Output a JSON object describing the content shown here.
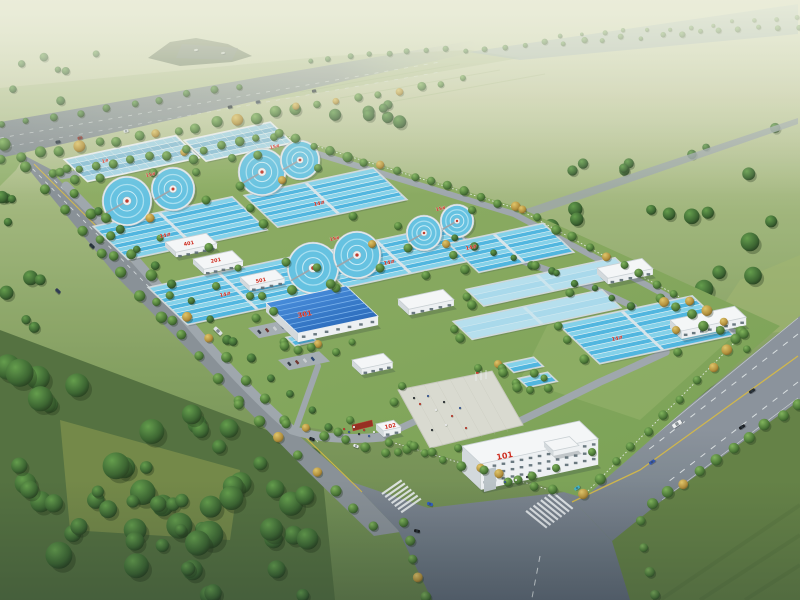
{
  "scene": {
    "title": "Aerial rendering of a water treatment plant campus",
    "type": "architectural-visualization",
    "view": "bird's-eye oblique"
  },
  "colors": {
    "label_red": "#cc2418",
    "basin_water": "#49b4e0",
    "basin_water_pale": "#bfe2ef",
    "clarifier_water": "#5fc0e2",
    "workshop_roof_blue": "#2f7fd6",
    "building_wall_white": "#f5f7f9",
    "road_grey": "#858e96",
    "grass_green": "#7fa057",
    "forest_green": "#2f5226",
    "autumn_tree": "#d2b04a",
    "canal_water": "#97abb8"
  },
  "labels": {
    "office": "101",
    "gatehouse": "102",
    "workshop": "301",
    "aux_a": "401",
    "aux_b": "201",
    "aux_c": "501",
    "covered_basin": "1#",
    "basin_c1": "14#",
    "basin_c2": "14#",
    "basin_d1": "14#",
    "basin_d2": "14#",
    "basin_d3": "14#",
    "basin_e3": "14#",
    "clarifiers_p1": "15#",
    "clarifiers_p2": "15#",
    "clarifiers_p3": "15#",
    "clarifiers_p4": "15#"
  },
  "counts": {
    "circular_clarifier_tanks": 8,
    "rectangular_basin_groups": 13,
    "perimeter_roads": 4
  }
}
